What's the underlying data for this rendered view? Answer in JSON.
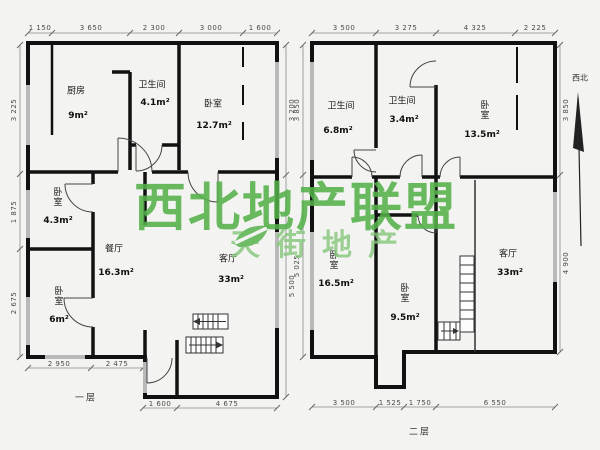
{
  "watermark": {
    "title": "西北地产联盟",
    "subtitle": "天街地产",
    "title_color": "#55b04a",
    "subtitle_color": "#86c77b"
  },
  "compass": {
    "label": "西北"
  },
  "floor1": {
    "name": "一层",
    "top_dims": [
      "1 150",
      "3 650",
      "2 300",
      "3 000",
      "1 600"
    ],
    "left_dims": [
      "3 225",
      "1 875",
      "2 675"
    ],
    "right_dims": [
      "3 200",
      "5 500"
    ],
    "bottom_dims_upper": [
      "2 950",
      "2 475"
    ],
    "bottom_dims_lower": [
      "1 600",
      "4 675"
    ],
    "rooms": [
      {
        "name": "厨房",
        "area": "9m²"
      },
      {
        "name": "卫生间",
        "area": "4.1m²"
      },
      {
        "name": "卧室",
        "area": "12.7m²"
      },
      {
        "name": "卧室",
        "area": "4.3m²"
      },
      {
        "name": "餐厅",
        "area": "16.3m²"
      },
      {
        "name": "客厅",
        "area": "33m²"
      },
      {
        "name": "卧室",
        "area": "6m²"
      }
    ]
  },
  "floor2": {
    "name": "二层",
    "top_dims": [
      "3 500",
      "3 275",
      "4 325",
      "2 225"
    ],
    "left_dims": [
      "3 850",
      "5 025"
    ],
    "right_dims": [
      "3 850",
      "4 900"
    ],
    "bottom_dims": [
      "3 500",
      "1 525",
      "1 750",
      "6 550"
    ],
    "rooms": [
      {
        "name": "卫生间",
        "area": "6.8m²"
      },
      {
        "name": "卫生间",
        "area": "3.4m²"
      },
      {
        "name": "卧室",
        "area": "13.5m²"
      },
      {
        "name": "卧室",
        "area": "16.5m²"
      },
      {
        "name": "卧室",
        "area": "9.5m²"
      },
      {
        "name": "客厅",
        "area": "33m²"
      }
    ]
  }
}
